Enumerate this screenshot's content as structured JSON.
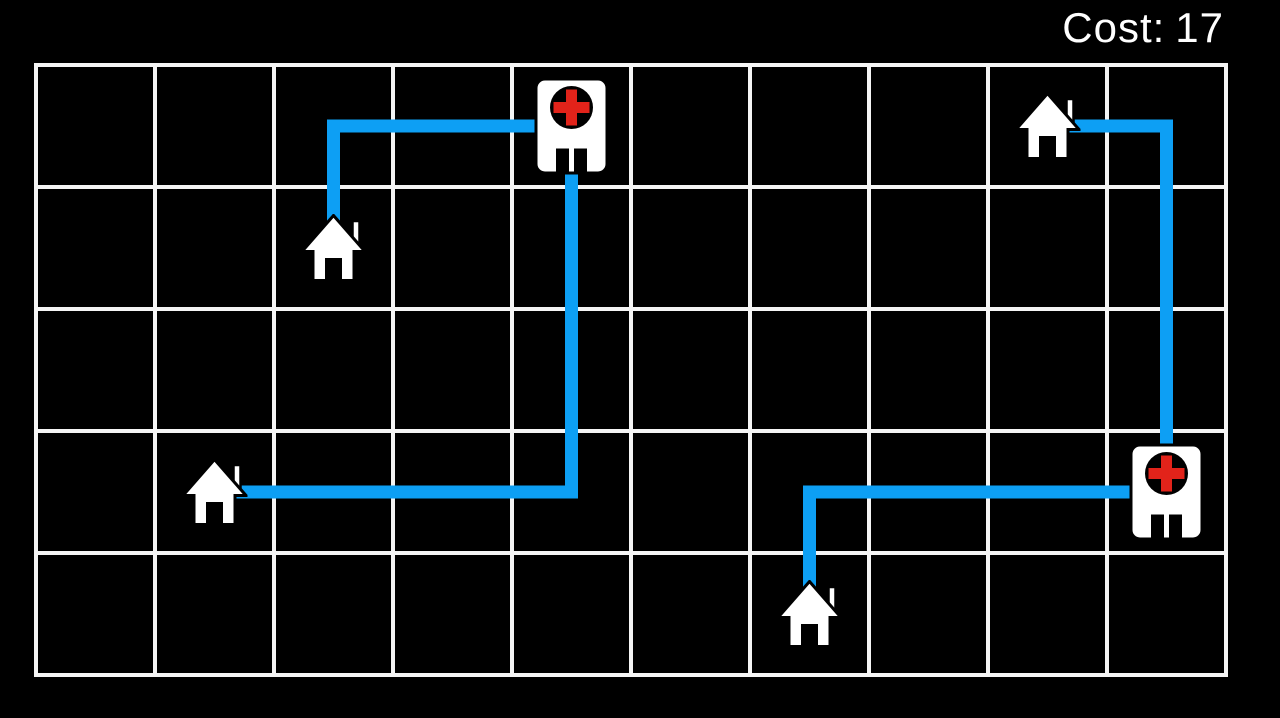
{
  "hud": {
    "cost_label": "Cost:",
    "cost_value": "17"
  },
  "board": {
    "background": "#000000",
    "grid": {
      "cols": 10,
      "rows": 5,
      "left": 36,
      "top": 65,
      "cell_width": 119,
      "cell_height": 122,
      "line_color": "#f5f5f5",
      "line_width": 4
    },
    "route_style": {
      "color": "#0d9ff4",
      "stroke_width": 13
    },
    "icon_colors": {
      "fill": "#ffffff",
      "outline": "#000000",
      "dark": "#000000",
      "cross_red": "#e2231a"
    },
    "houses": [
      {
        "id": "house-1",
        "icon": "house-icon",
        "col": 3,
        "row": 2
      },
      {
        "id": "house-2",
        "icon": "house-icon",
        "col": 2,
        "row": 4
      },
      {
        "id": "house-3",
        "icon": "house-icon",
        "col": 9,
        "row": 1
      },
      {
        "id": "house-4",
        "icon": "house-icon",
        "col": 7,
        "row": 5
      }
    ],
    "hospitals": [
      {
        "id": "hospital-1",
        "icon": "hospital-icon",
        "col": 5,
        "row": 1
      },
      {
        "id": "hospital-2",
        "icon": "hospital-icon",
        "col": 10,
        "row": 4
      }
    ],
    "routes": [
      {
        "from": "house-1",
        "to": "hospital-1",
        "cells": [
          [
            3,
            2
          ],
          [
            3,
            1
          ],
          [
            5,
            1
          ]
        ]
      },
      {
        "from": "house-2",
        "to": "hospital-1",
        "cells": [
          [
            2,
            4
          ],
          [
            5,
            4
          ],
          [
            5,
            1
          ]
        ]
      },
      {
        "from": "house-3",
        "to": "hospital-2",
        "cells": [
          [
            9,
            1
          ],
          [
            10,
            1
          ],
          [
            10,
            4
          ]
        ]
      },
      {
        "from": "house-4",
        "to": "hospital-2",
        "cells": [
          [
            7,
            5
          ],
          [
            7,
            4
          ],
          [
            10,
            4
          ]
        ]
      }
    ]
  }
}
